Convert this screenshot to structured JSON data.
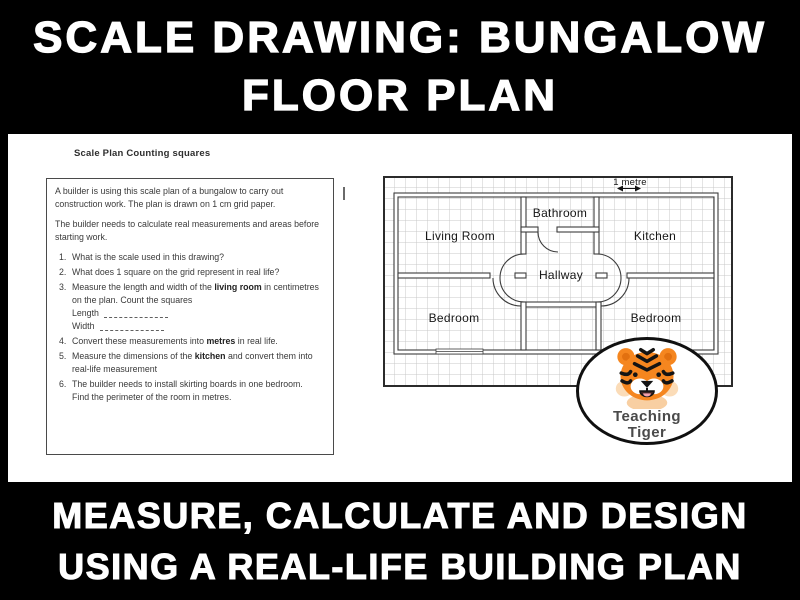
{
  "colors": {
    "background": "#000000",
    "banner_text": "#ffffff",
    "panel": "#ffffff",
    "worksheet_text": "#3a3a3a",
    "plan_line": "#3c3c3c",
    "grid_line": "#c9c9c9",
    "tiger_orange": "#f5861f",
    "logo_text": "#4a4a4a"
  },
  "top_banner": {
    "line1": "SCALE DRAWING: BUNGALOW",
    "line2": "FLOOR PLAN"
  },
  "bottom_banner": {
    "line1": "MEASURE, CALCULATE AND DESIGN",
    "line2": "USING A REAL-LIFE BUILDING PLAN"
  },
  "worksheet": {
    "title": "Scale Plan Counting squares",
    "intro1": "A builder is using this scale plan of a bungalow to carry out construction work. The plan is drawn on 1 cm grid paper.",
    "intro2": "The builder needs to calculate real measurements and areas before starting work.",
    "questions": [
      {
        "num": "1.",
        "pre": "What is the scale used in this drawing?",
        "bold": "",
        "post": ""
      },
      {
        "num": "2.",
        "pre": "What does 1 square on the grid represent in real life?",
        "bold": "",
        "post": ""
      },
      {
        "num": "3.",
        "pre": "Measure the length and width of the ",
        "bold": "living room",
        "post": " in centimetres on the plan. Count the squares",
        "length_label": "Length",
        "width_label": "Width"
      },
      {
        "num": "4.",
        "pre": "Convert these measurements into ",
        "bold": "metres",
        "post": " in real life.",
        "line2": ""
      },
      {
        "num": "5.",
        "pre": "Measure the dimensions of the ",
        "bold": "kitchen",
        "post": " and convert them into real-life measurement",
        "line2": ""
      },
      {
        "num": "6.",
        "pre": "The builder needs to install skirting boards in one bedroom.",
        "bold": "",
        "post": "",
        "line2": "Find the perimeter of the room in metres."
      }
    ]
  },
  "floor_plan": {
    "scale_label": "1 metre",
    "rooms": [
      {
        "name": "Living Room"
      },
      {
        "name": "Bathroom"
      },
      {
        "name": "Kitchen"
      },
      {
        "name": "Hallway"
      },
      {
        "name": "Bedroom"
      },
      {
        "name": "Bedroom"
      }
    ]
  },
  "logo": {
    "line1": "Teaching",
    "line2": "Tiger"
  }
}
